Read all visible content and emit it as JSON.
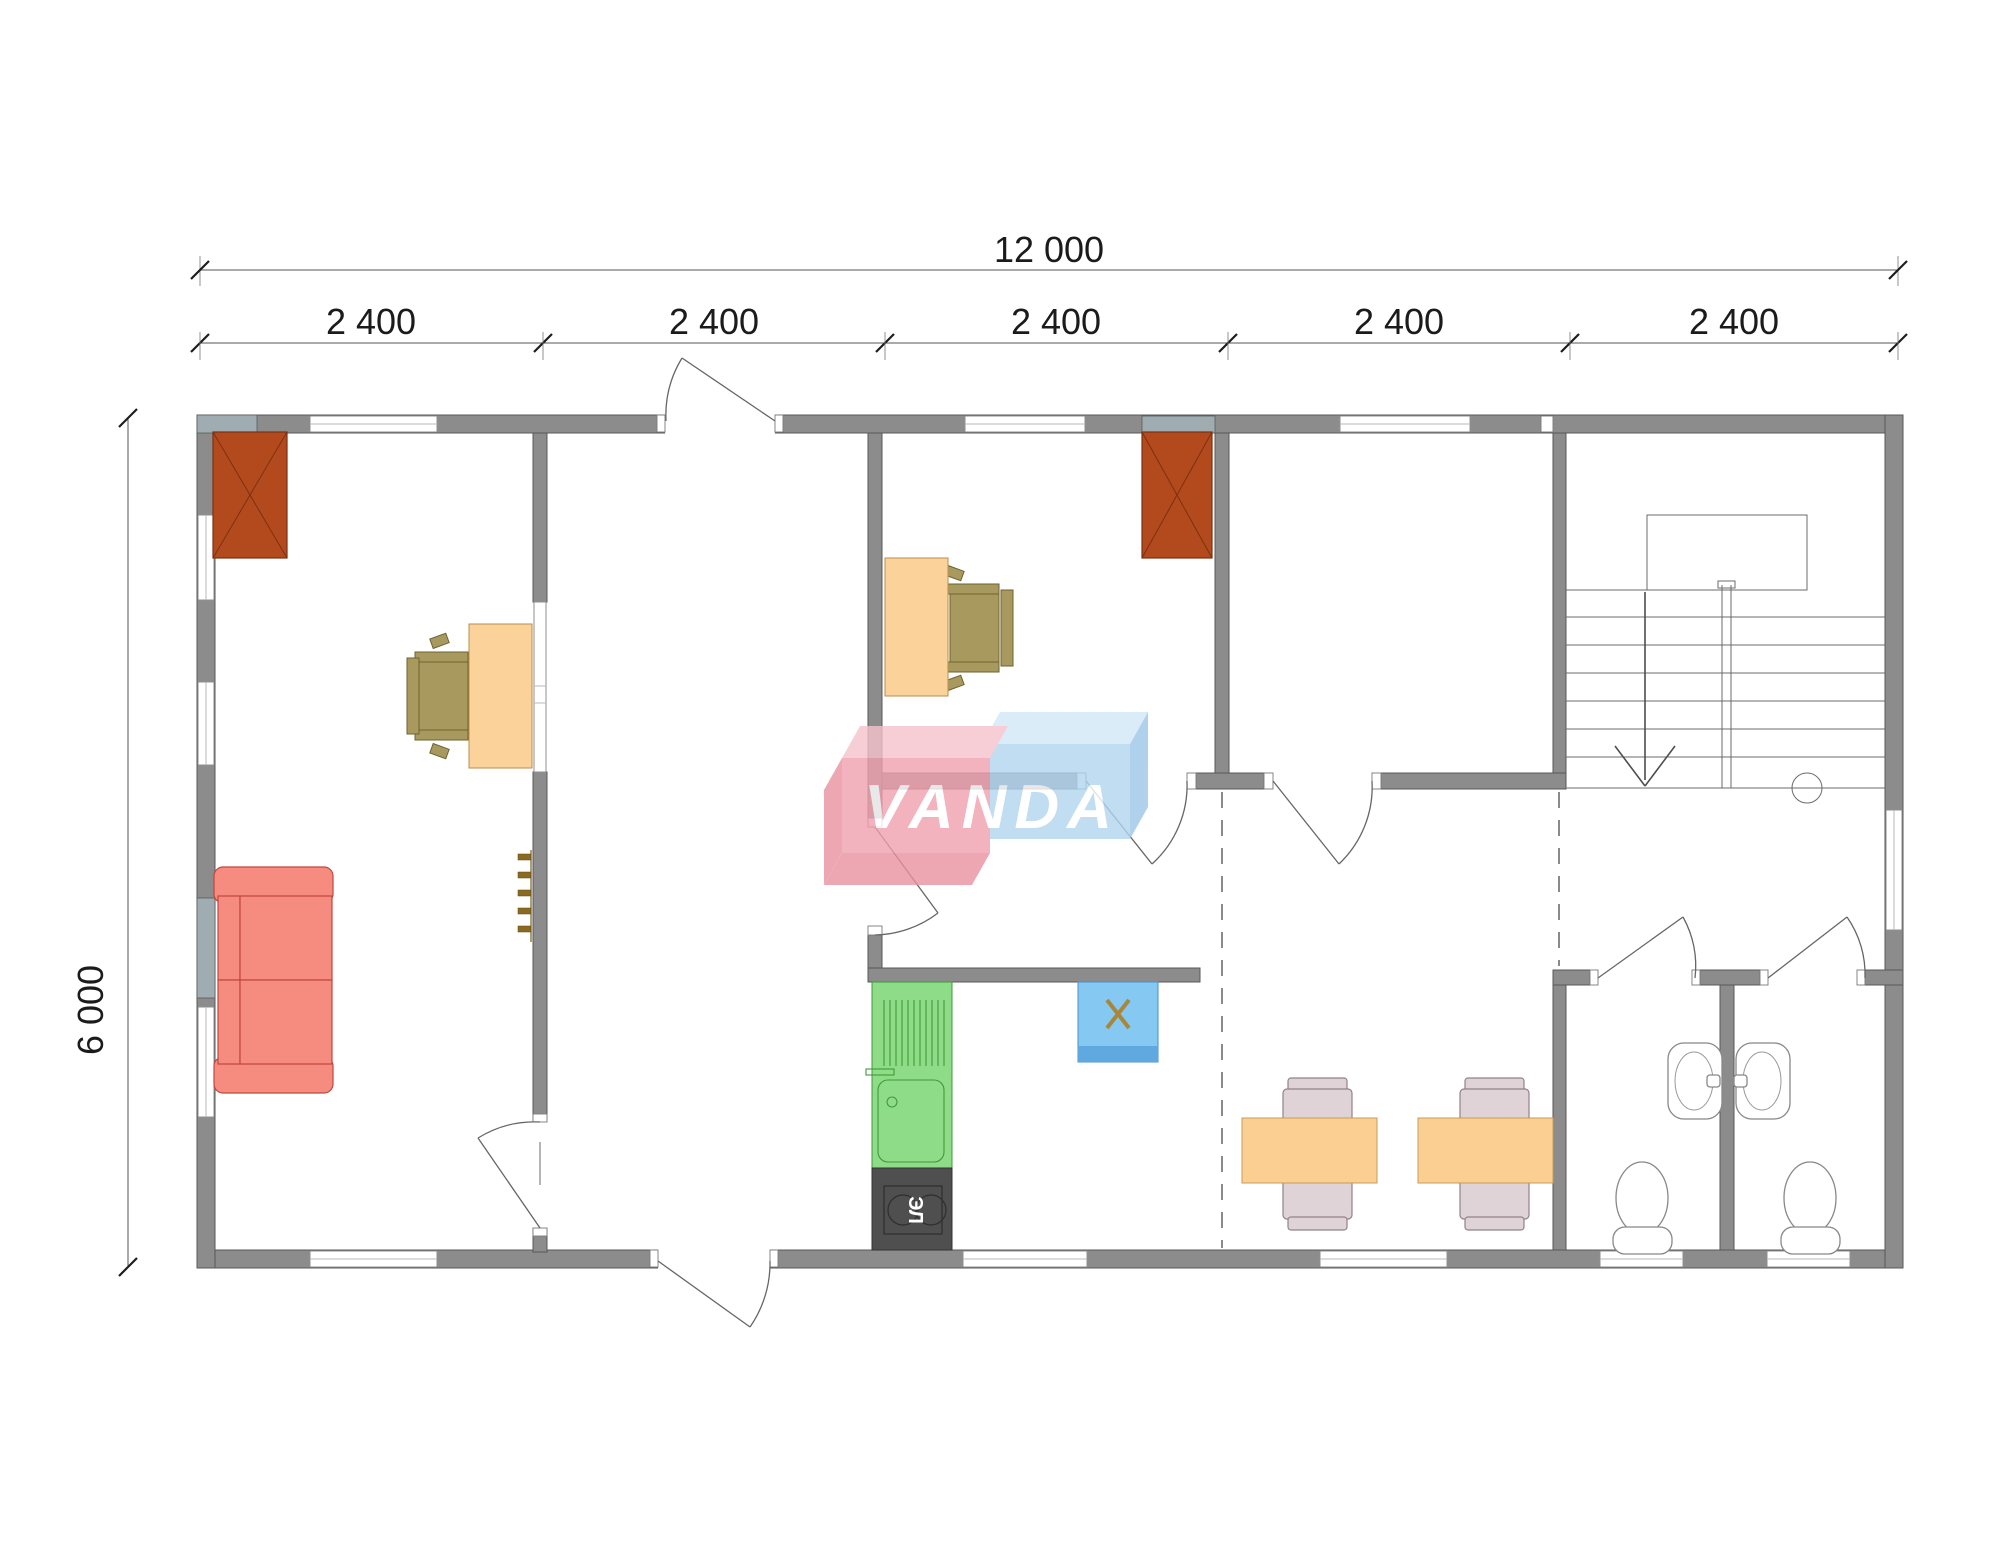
{
  "canvas": {
    "width": 2000,
    "height": 1563
  },
  "dimensions": {
    "total_width_label": "12 000",
    "module_labels": [
      "2 400",
      "2 400",
      "2 400",
      "2 400",
      "2 400"
    ],
    "height_label": "6 000"
  },
  "watermark": {
    "text": "VANDA"
  },
  "equipment_labels": {
    "stove": "ЭЛ"
  },
  "colors": {
    "wall": "#8c8c8c",
    "wall_stroke": "#595959",
    "wall_accent": "#9fadb3",
    "chimney": "#b34a1e",
    "chimney_stroke": "#7c3011",
    "desk": "#fbd299",
    "desk_stroke": "#bb8e4d",
    "office_chair": "#a89a5e",
    "office_chair_stroke": "#6e6230",
    "sofa": "#f68c80",
    "sofa_stroke": "#c0473c",
    "counter": "#8edc87",
    "counter_stroke": "#3e9a38",
    "stove": "#4f4f4f",
    "boiler": "#85c8f2",
    "boiler_dark": "#5fa8e0",
    "boiler_x": "#a8873b",
    "table": "#fbcf92",
    "table_stroke": "#c79b55",
    "dining_chair": "#e0d3d8",
    "dining_chair_stroke": "#8f8289",
    "fixture_stroke": "#888888",
    "logo_pink": "#f0a0ae",
    "logo_pink_light": "#f7c3cd",
    "logo_pink_dark": "#e992a1",
    "logo_blue": "#b1d5f0",
    "logo_blue_light": "#d3e8f8",
    "logo_blue_dark": "#9dc6e8",
    "dim_color": "#1b1b1b",
    "line_color": "#6b6b6b"
  }
}
